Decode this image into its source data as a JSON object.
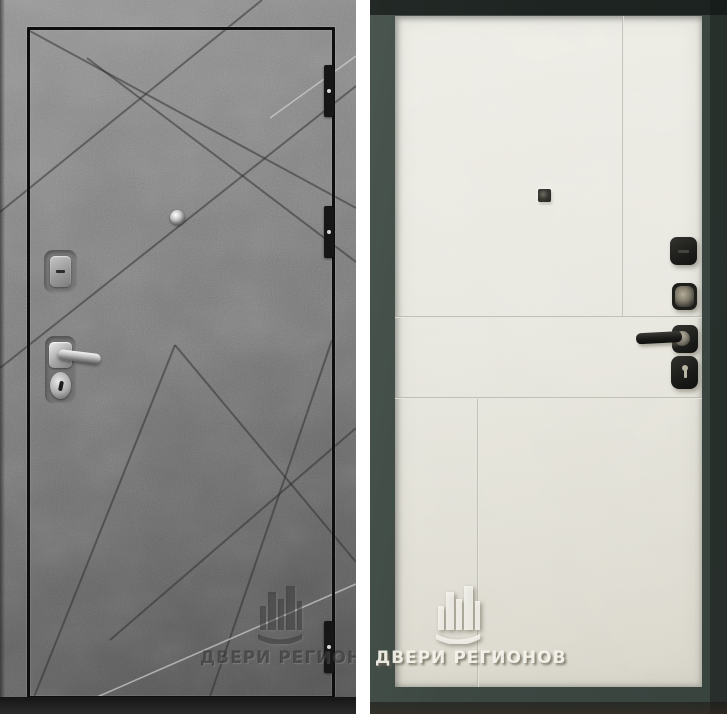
{
  "background_color": "#ffffff",
  "left_door": {
    "watermark_text": "ДВЕРИ РЕГИОНОВ",
    "leaf_color": "#7b7b7b",
    "edge_color": "#0e0e0e",
    "hardware_color": "#c9c9c9"
  },
  "right_door": {
    "watermark_text": "ДВЕРИ РЕГИОНОВ",
    "frame_color": "#3d4843",
    "leaf_color": "#ebeae2",
    "hardware_color": "#1e1e1c"
  }
}
